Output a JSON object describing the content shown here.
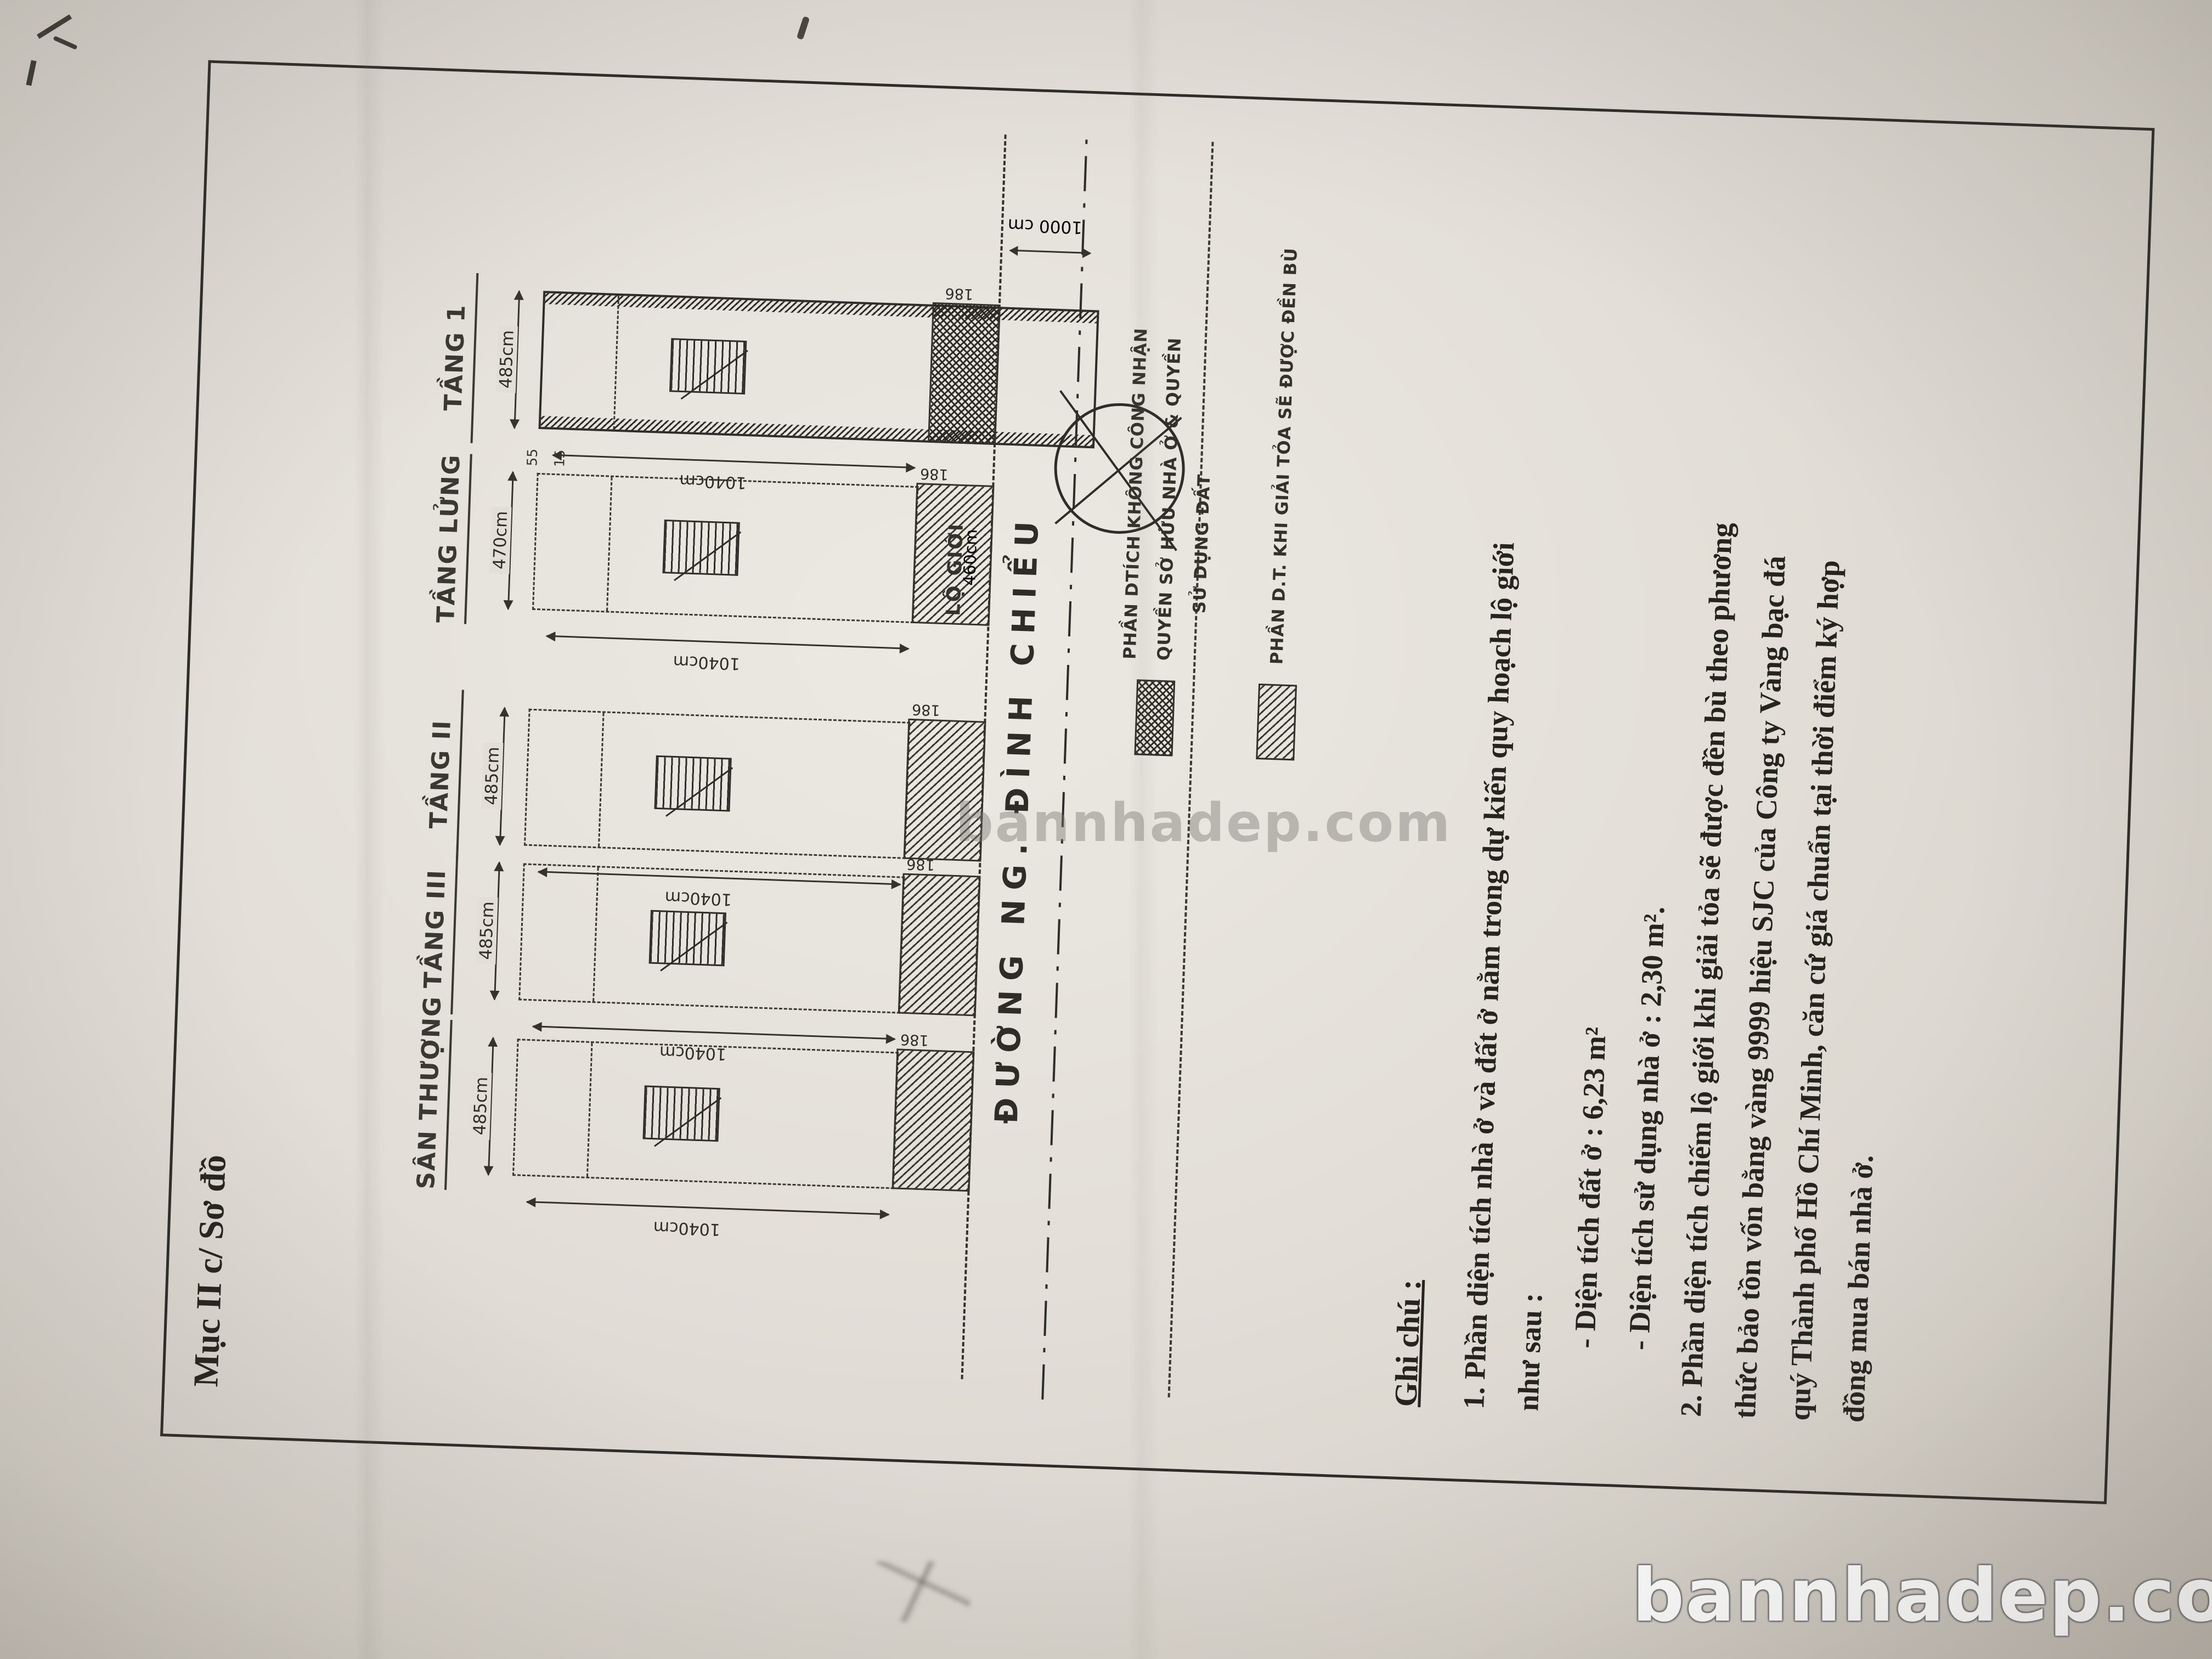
{
  "header": {
    "title": "Mục II c/ Sơ đồ"
  },
  "plans": [
    {
      "label": "SÂN THƯỢNG",
      "width_dim": "485cm",
      "depth_dim": "1040cm",
      "encroach_dim": "186"
    },
    {
      "label": "TẦNG III",
      "width_dim": "485cm",
      "depth_dim": "1040cm",
      "encroach_dim": "186"
    },
    {
      "label": "TẦNG II",
      "width_dim": "485cm",
      "depth_dim": "1040cm",
      "encroach_dim": "186"
    },
    {
      "label": "TẦNG LỬNG",
      "width_dim": "470cm",
      "depth_dim": "1040cm",
      "encroach_dim": "186",
      "side_dims": [
        "55",
        "15"
      ]
    },
    {
      "label": "TẦNG 1",
      "width_dim": "485cm",
      "depth_dim": "1040cm",
      "encroach_dim": "186",
      "strip_dim": "460cm"
    }
  ],
  "street": {
    "name": "ĐƯỜNG NG. ĐÌNH CHIỂU",
    "lo_gioi_label": "LỘ GIỚI",
    "center_dim": "1000 cm"
  },
  "legend": {
    "items": [
      {
        "pattern": "crosshatch",
        "lines": [
          "PHẦN DTÍCH KHÔNG CÔNG NHẬN",
          "QUYỀN SỞ HỮU NHÀ Ở & QUYỀN",
          "SỬ DỤNG ĐẤT"
        ]
      },
      {
        "pattern": "diagonal-hatch",
        "lines": [
          "PHẦN D.T. KHI GIẢI TỎA SẼ ĐƯỢC ĐỀN BÙ"
        ]
      }
    ]
  },
  "notes": {
    "heading": "Ghi chú :",
    "lines": [
      "1. Phần diện tích nhà ở và đất ở nằm trong dự kiến quy hoạch lộ giới",
      "như sau :",
      "- Diện tích đất ở : 6,23 m²",
      "- Diện tích sử dụng nhà ở : 2,30 m².",
      "2. Phần diện tích chiếm lộ giới khi giải tỏa sẽ được đền bù theo phương",
      "thức bảo tồn vốn bằng vàng 9999 hiệu SJC của Công ty Vàng bạc đá",
      "quý Thành phố Hồ Chí Minh, căn cứ giá chuẩn tại thời điểm ký hợp",
      "đồng mua bán nhà ở."
    ]
  },
  "watermarks": {
    "center": "bannhadep.com",
    "corner": "bannhadep.com"
  }
}
